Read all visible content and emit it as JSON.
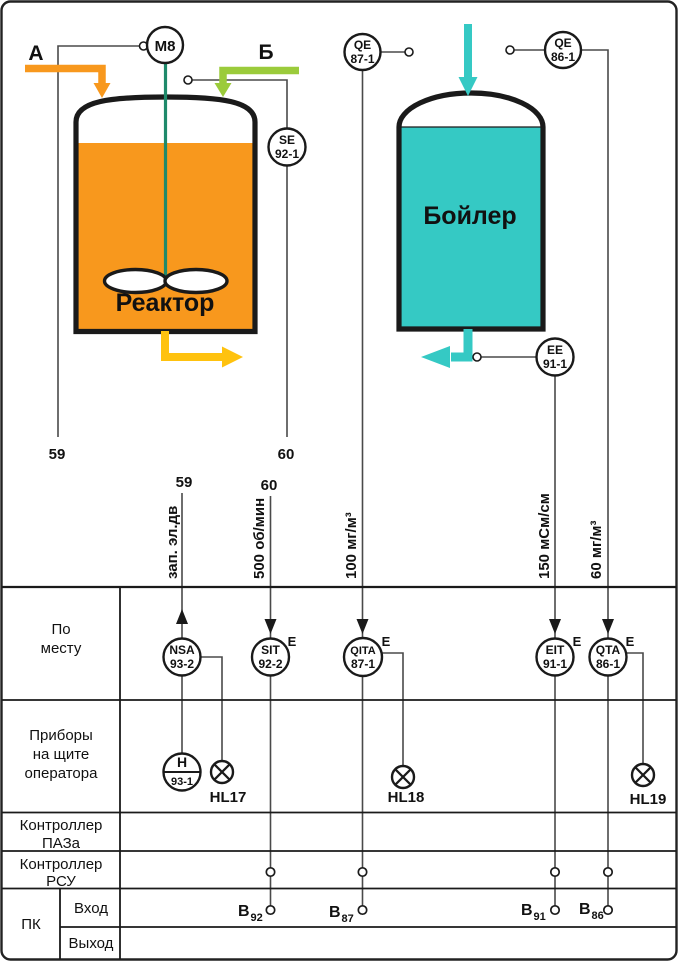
{
  "colors": {
    "orange": "#F8981D",
    "yellow": "#FFC20E",
    "green": "#9BCB3B",
    "cyan": "#35C9C4",
    "shaft_teal": "#1F8A6B"
  },
  "diagram": {
    "reactor": {
      "label": "Реактор",
      "motor_tag": "М8",
      "stream_in_a": "А",
      "stream_in_b": "Б",
      "line_left_no": "59",
      "line_right_no": "60"
    },
    "boiler": {
      "label": "Бойлер"
    },
    "field_instruments": {
      "se92": {
        "l1": "SE",
        "l2": "92-1"
      },
      "qe87": {
        "l1": "QE",
        "l2": "87-1"
      },
      "qe86": {
        "l1": "QE",
        "l2": "86-1"
      },
      "ee91": {
        "l1": "EE",
        "l2": "91-1"
      }
    }
  },
  "signals": {
    "s59": {
      "no": "59",
      "desc": "зап.  эл.дв"
    },
    "s60": {
      "no": "60",
      "desc": "500 об/мин"
    },
    "s87": {
      "desc": "100 мг/м³"
    },
    "s91": {
      "desc": "150 мСм/см"
    },
    "s86": {
      "desc": "60 мг/м³"
    }
  },
  "table": {
    "rows": {
      "local": {
        "line1": "По",
        "line2": "месту"
      },
      "panel": {
        "line1": "Приборы",
        "line2": "на щите",
        "line3": "оператора"
      },
      "esd": {
        "line1": "Контроллер",
        "line2": "ПАЗа"
      },
      "dcs": {
        "line1": "Контроллер",
        "line2": "РСУ"
      },
      "pc": {
        "label": "ПК",
        "in": "Вход",
        "out": "Выход"
      }
    },
    "instruments": {
      "nsa": {
        "l1": "NSA",
        "l2": "93-2"
      },
      "sit": {
        "l1": "SIT",
        "l2": "92-2",
        "sup": "E"
      },
      "qita": {
        "l1": "QITA",
        "l2": "87-1",
        "sup": "E"
      },
      "eit": {
        "l1": "EIT",
        "l2": "91-1",
        "sup": "E"
      },
      "qta": {
        "l1": "QTA",
        "l2": "86-1",
        "sup": "E"
      },
      "h": {
        "l1": "H",
        "l2": "93-1"
      }
    },
    "lamps": {
      "hl17": "HL17",
      "hl18": "HL18",
      "hl19": "HL19"
    },
    "pc_inputs": {
      "b92": {
        "base": "B",
        "sub": "92"
      },
      "b87": {
        "base": "B",
        "sub": "87"
      },
      "b91": {
        "base": "B",
        "sub": "91"
      },
      "b86": {
        "base": "B",
        "sub": "86"
      }
    }
  }
}
